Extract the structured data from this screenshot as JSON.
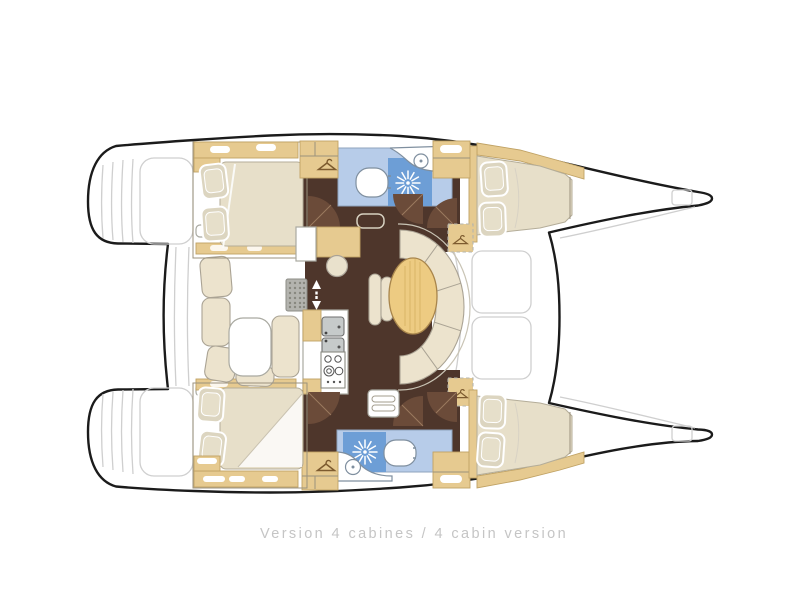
{
  "caption": {
    "text": "Version 4 cabines / 4 cabin version"
  },
  "plan": {
    "cabin_count": 4
  },
  "icons": {
    "wardrobe": "hanger-icon",
    "shower": "sunburst-icon",
    "companionway": "up-down-arrows-icon"
  },
  "colors": {
    "hull_outline": "#1b1b1b",
    "wood_tan": "#e6ca90",
    "wood_tan_border": "#c0a264",
    "floor_wenge": "#4e362b",
    "door_brown": "#6b4b39",
    "cushion_cream": "#ece3cd",
    "mattress": "#e7dfc9",
    "pillow": "#dcd5c0",
    "bath_light_blue": "#b7cce9",
    "shower_blue": "#6d9ed6",
    "table_wood": "#edcb82",
    "faint_gray": "#cfcfcf",
    "caption_gray": "#c5c5c5"
  }
}
